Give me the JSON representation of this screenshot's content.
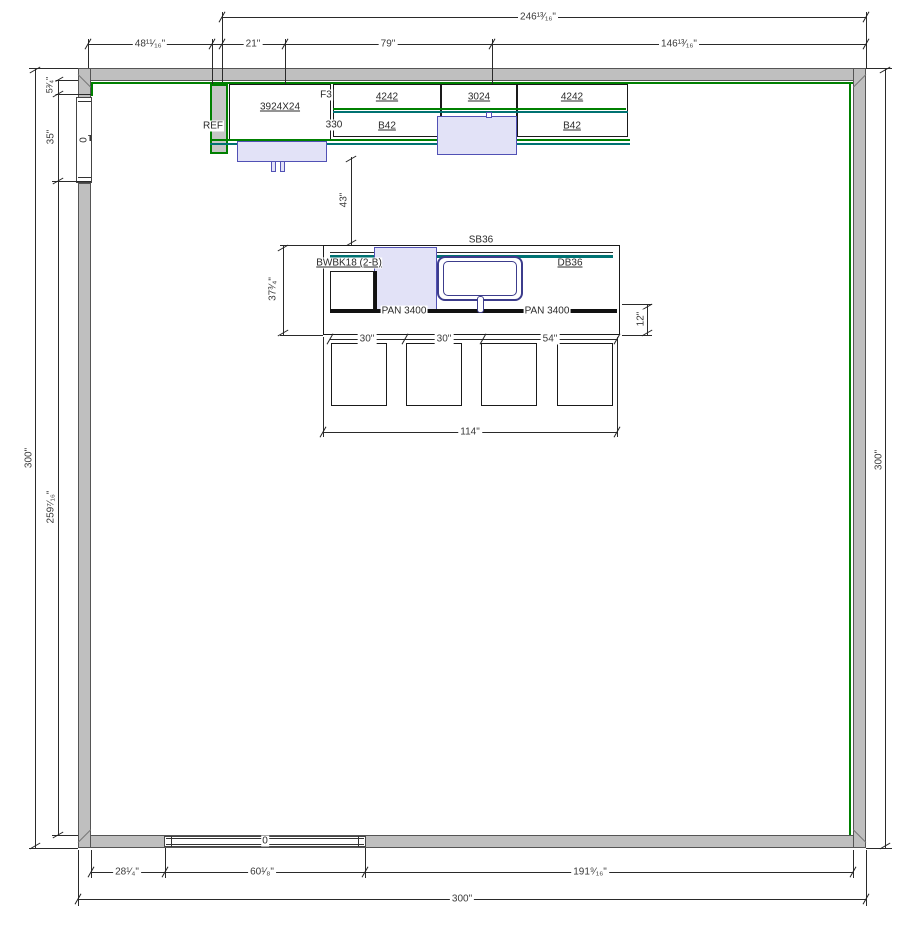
{
  "colors": {
    "wall_gray": "#bfbfbf",
    "countertop_green": "#008000",
    "edge_teal": "#007272",
    "appliance_fill": "#e2e2f7",
    "appliance_border": "#5151b5",
    "sink_navy": "#3c3c8c"
  },
  "dims": {
    "top_overall": "246¹³⁄₁₆\"",
    "top_seg_1": "48¹¹⁄₁₆\"",
    "top_seg_2": "21\"",
    "top_seg_3": "79\"",
    "top_seg_4": "146¹³⁄₁₆\"",
    "left_outer": "300\"",
    "left_seg_1": "5³⁄₄\"",
    "left_seg_2": "35\"",
    "left_seg_3": "259⁷⁄₁₆\"",
    "right_outer": "300\"",
    "aisle_clearance": "43\"",
    "island_depth": "37³⁄₄\"",
    "island_overhang": "12\"",
    "island_seg_1": "30\"",
    "island_seg_2": "30\"",
    "island_seg_3": "54\"",
    "island_overall": "114\"",
    "bottom_seg_1": "28¹⁄₄\"",
    "bottom_seg_2": "60¹⁄₈\"",
    "bottom_seg_3": "191⁹⁄₁₆\"",
    "bottom_overall": "300\""
  },
  "cabinets": {
    "ref": "REF",
    "tall_cabinet": "3924X24",
    "filler_top": "F3",
    "filler_bottom": "330",
    "wall_cabinet_1": "4242",
    "wall_cabinet_2": "3024",
    "wall_cabinet_3": "4242",
    "base_cabinet_1": "B42",
    "base_cabinet_2": "B42",
    "sink_base": "SB36",
    "island_left_cabinet": "BWBK18 (2-B)",
    "island_drawer_base": "DB36",
    "panel_left": "PAN 3400",
    "panel_right": "PAN 3400"
  },
  "windows": {
    "left_tag": "0",
    "bottom_tag": "0"
  }
}
